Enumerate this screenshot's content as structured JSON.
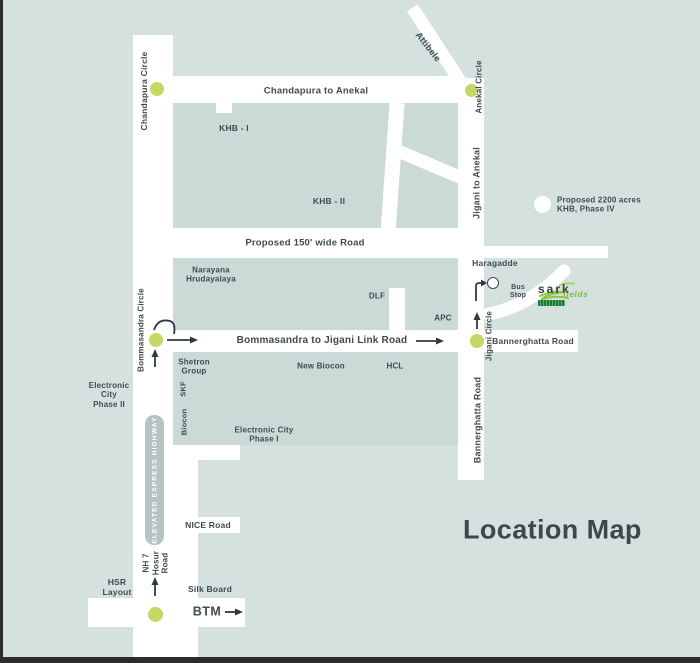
{
  "title": "Location Map",
  "roads": {
    "chandapura_anekal": "Chandapura to Anekal",
    "proposed_150": "Proposed 150' wide Road",
    "link_road": "Bommasandra to Jigani Link Road",
    "bannerghatta_h": "Bannerghatta Road",
    "bannerghatta_v": "Bannerghatta Road",
    "jigani_anekal": "Jigani to Anekal",
    "attibele": "Attibele",
    "nice_road": "NICE Road",
    "nh7": "NH 7\nHosur\nRoad",
    "elevated": "ELEVATED EXPRESS HIGHWAY"
  },
  "junctions": {
    "chandapura_circle": "Chandapura Circle",
    "anekal_circle": "Anekal Circle",
    "bommasandra_circle": "Bommasandra Circle",
    "jigani_circle": "Jigani Circle"
  },
  "places": {
    "khb1": "KHB - I",
    "khb2": "KHB - II",
    "khb_phase4": "Proposed 2200 acres\nKHB, Phase IV",
    "narayana": "Narayana\nHrudayalaya",
    "dlf": "DLF",
    "apc": "APC",
    "haragadde": "Haragadde",
    "bus_stop": "Bus\nStop",
    "shetron": "Shetron\nGroup",
    "skf": "SKF",
    "biocon": "Biocon",
    "new_biocon": "New Biocon",
    "hcl": "HCL",
    "ec_phase2": "Electronic\nCity\nPhase II",
    "ec_phase1": "Electronic City\nPhase I",
    "hsr": "HSR\nLayout",
    "silk_board": "Silk Board",
    "btm": "BTM"
  },
  "logo": {
    "brand": "sark",
    "brand2": "fields"
  },
  "colors": {
    "background": "#d5e1df",
    "block": "#cbdad7",
    "road": "#ffffff",
    "junction_dot": "#c5d764",
    "text": "#3e4b51",
    "elevated_band": "#b7c3c3",
    "logo_green": "#7cc141",
    "title": "#3f464c"
  }
}
